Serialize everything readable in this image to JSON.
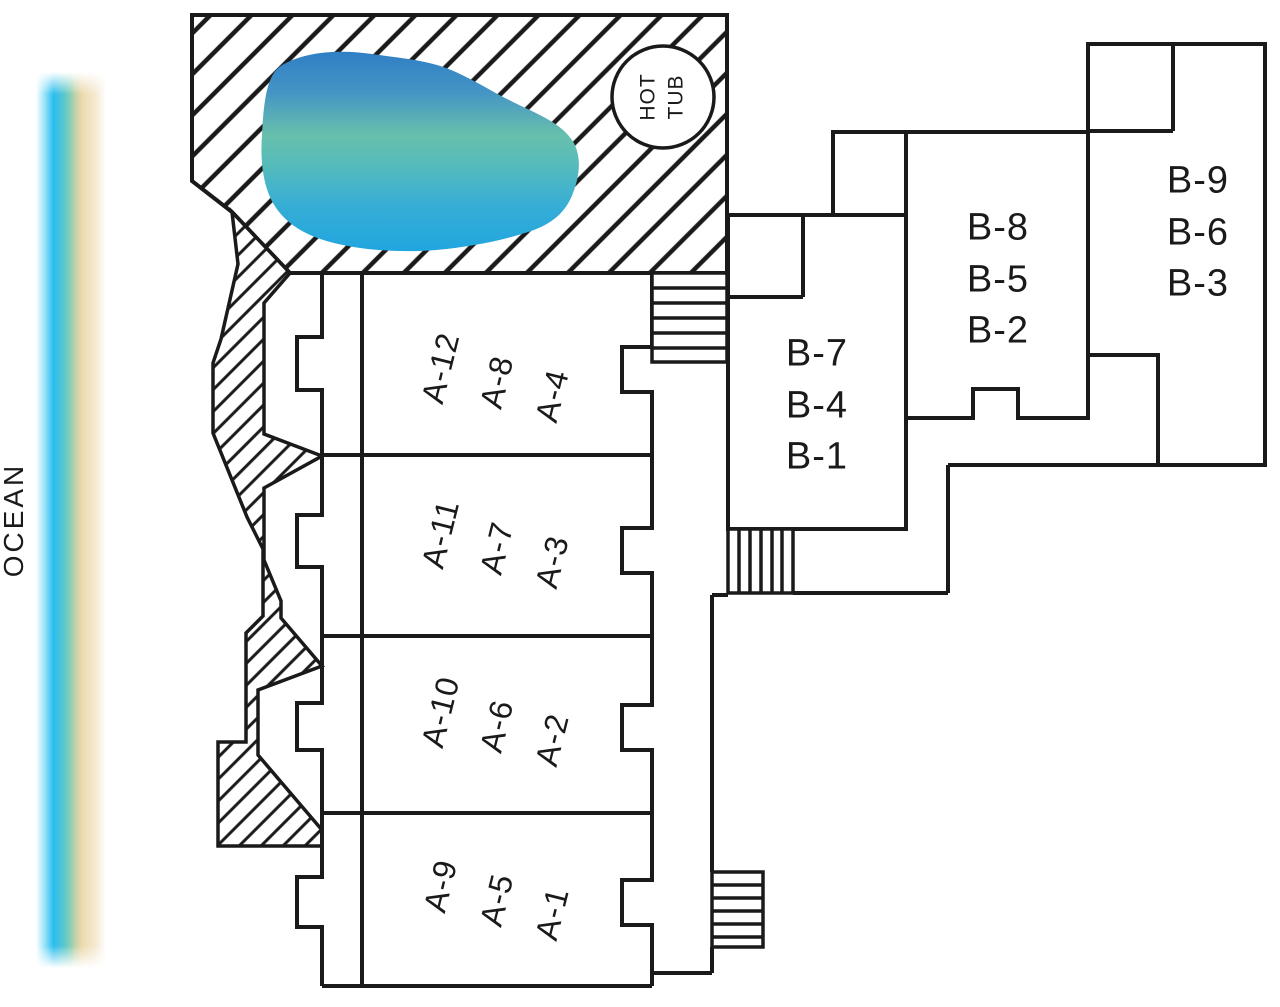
{
  "ocean": {
    "label": "OCEAN"
  },
  "hot_tub": {
    "line1": "HOT",
    "line2": "TUB"
  },
  "building_a": {
    "rows": [
      {
        "units": [
          "A-12",
          "A-8",
          "A-4"
        ]
      },
      {
        "units": [
          "A-11",
          "A-7",
          "A-3"
        ]
      },
      {
        "units": [
          "A-10",
          "A-6",
          "A-2"
        ]
      },
      {
        "units": [
          "A-9",
          "A-5",
          "A-1"
        ]
      }
    ]
  },
  "building_b": {
    "stacks": [
      {
        "units": [
          "B-7",
          "B-4",
          "B-1"
        ]
      },
      {
        "units": [
          "B-8",
          "B-5",
          "B-2"
        ]
      },
      {
        "units": [
          "B-9",
          "B-6",
          "B-3"
        ]
      }
    ]
  },
  "colors": {
    "line": "#1a1a1a",
    "pool_blue_top": "#2f7fc5",
    "pool_blue_upper": "#4494c5",
    "pool_teal": "#67c0ac",
    "pool_teal_lower": "#54bbbd",
    "pool_blue_lower": "#35add6",
    "pool_blue_bottom": "#21a6df",
    "ocean_white": "#ffffff",
    "ocean_cyan_pale": "#8adef7",
    "ocean_cyan": "#29bdf0",
    "ocean_teal": "#63c8c9",
    "ocean_green": "#8fceb2",
    "ocean_olive": "#c9d2a8",
    "ocean_sand": "#ecd9ae",
    "ocean_sand_pale": "#f4ead1"
  }
}
